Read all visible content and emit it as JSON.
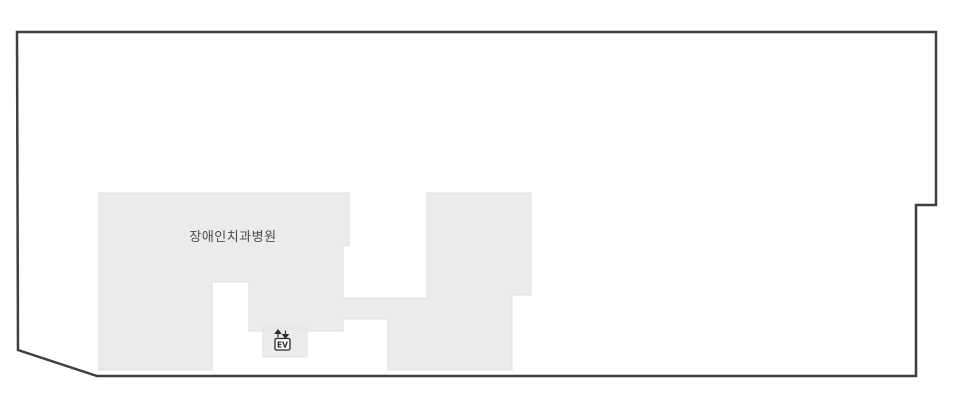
{
  "floorplan": {
    "canvas": {
      "width": 954,
      "height": 411,
      "background": "#ffffff"
    },
    "outline": {
      "points": [
        [
          17,
          32
        ],
        [
          936,
          32
        ],
        [
          936,
          205
        ],
        [
          916,
          205
        ],
        [
          916,
          376
        ],
        [
          97,
          376
        ],
        [
          18,
          350
        ]
      ],
      "fill": "#ffffff",
      "stroke": "#3f3f3f",
      "stroke_width": 2.5
    },
    "building": {
      "label": "장애인치과병원",
      "points": [
        [
          99,
          193
        ],
        [
          349,
          193
        ],
        [
          349,
          246
        ],
        [
          343,
          246
        ],
        [
          343,
          298
        ],
        [
          427,
          298
        ],
        [
          427,
          193
        ],
        [
          531,
          193
        ],
        [
          531,
          295
        ],
        [
          512,
          295
        ],
        [
          512,
          370
        ],
        [
          388,
          370
        ],
        [
          388,
          319
        ],
        [
          343,
          319
        ],
        [
          343,
          331
        ],
        [
          307,
          331
        ],
        [
          307,
          357
        ],
        [
          263,
          357
        ],
        [
          263,
          331
        ],
        [
          249,
          331
        ],
        [
          249,
          282
        ],
        [
          212,
          282
        ],
        [
          212,
          370
        ],
        [
          99,
          370
        ]
      ],
      "fill": "#ebebeb",
      "stroke": "#e0e0e0",
      "stroke_width": 1,
      "label_color": "#4d4d4d",
      "label_x": 233,
      "label_y": 241,
      "label_font_size": 13
    },
    "elevator_room": {
      "points": [
        [
          263,
          328
        ],
        [
          307,
          328
        ],
        [
          307,
          357
        ],
        [
          263,
          357
        ]
      ],
      "fill": "#ebebeb",
      "stroke": "#e0e0e0",
      "stroke_width": 1
    },
    "elevator_icon": {
      "label": "EV",
      "color": "#2b2b2b",
      "box_fill": "#fdfdfd"
    }
  }
}
